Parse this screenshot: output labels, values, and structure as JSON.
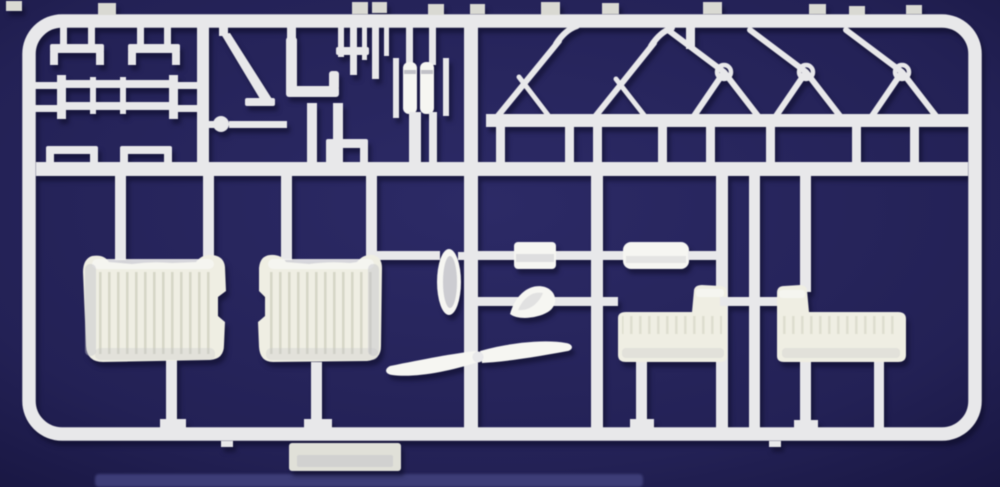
{
  "meta": {
    "subject": "Photograph of a white injection-molded model kit sprue (plastic parts tree) on a dark navy-blue background",
    "orientation": "landscape"
  },
  "colors": {
    "plastic": "#e8e8ea",
    "plastic-bright": "#f6f6f2",
    "plastic-shadow": "#c2c2c8",
    "seat": "#efeee3",
    "rib": "#d0d0c0",
    "tab": "#d9d9d3",
    "plate": "#e0e0d8",
    "strip": "#3d3d77",
    "bg-center": "#2c2a66",
    "bg-edge": "#181641"
  },
  "parts": [
    {
      "id": "sprue-frame",
      "label": "rounded rectangular sprue frame with molding tabs"
    },
    {
      "id": "mid-runner",
      "label": "horizontal mid runner"
    },
    {
      "id": "sub-runner",
      "label": "upper-right secondary runner"
    },
    {
      "id": "brackets",
      "label": "small U-bracket parts (top left)"
    },
    {
      "id": "ladder-frame",
      "label": "ladder-like frame part"
    },
    {
      "id": "ball-rod",
      "label": "ball-ended linkage rod"
    },
    {
      "id": "diagonal-strut",
      "label": "diagonal strut part"
    },
    {
      "id": "elbow-pipe",
      "label": "L-shaped elbow part"
    },
    {
      "id": "twin-cylinders",
      "label": "paired cylinder part"
    },
    {
      "id": "triangle-struts",
      "label": "two triangular strut frames"
    },
    {
      "id": "a-frame-struts",
      "label": "three A-frame struts with eyelet rings"
    },
    {
      "id": "bucket-seat-left",
      "label": "large ribbed bucket seat (left)"
    },
    {
      "id": "bucket-seat-right",
      "label": "large ribbed bucket seat (right)"
    },
    {
      "id": "drum",
      "label": "small drum / cowl ring"
    },
    {
      "id": "block",
      "label": "rectangular block part"
    },
    {
      "id": "teardrop",
      "label": "teardrop-shaped part"
    },
    {
      "id": "tank-cylinder",
      "label": "pill-shaped tank part"
    },
    {
      "id": "propeller",
      "label": "two-blade propeller"
    },
    {
      "id": "bench-seat-left",
      "label": "small bench seat with backrest (left)"
    },
    {
      "id": "bench-seat-right",
      "label": "small bench seat with backrest (right)"
    },
    {
      "id": "label-plate",
      "label": "blank molded plate under bottom rail"
    }
  ]
}
